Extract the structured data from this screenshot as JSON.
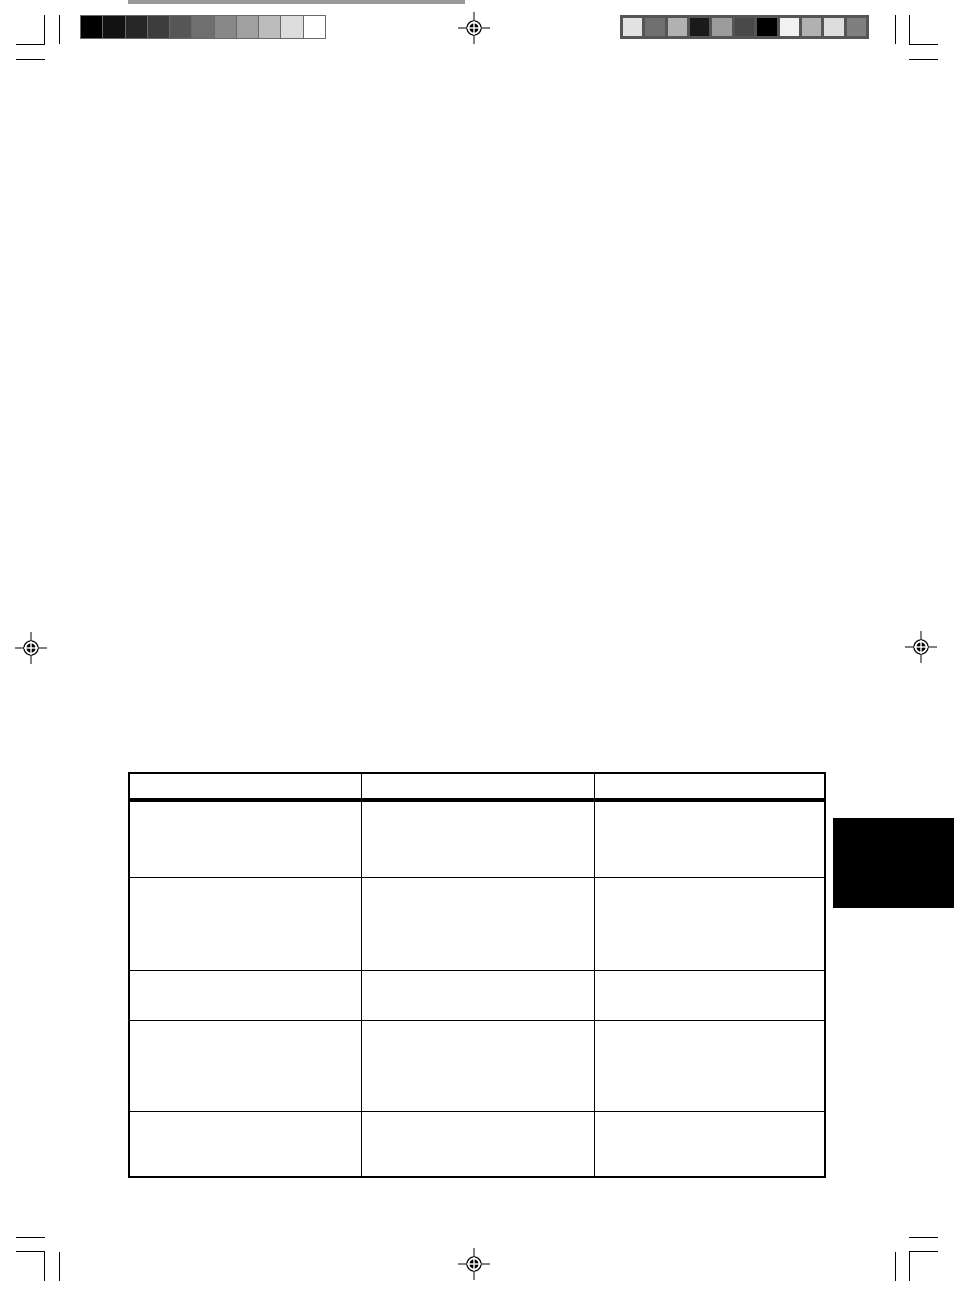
{
  "page": {
    "kind": "prepress-manual-page",
    "background_color": "#ffffff",
    "mark_color": "#000000"
  },
  "calibration": {
    "grayscale_bar": {
      "name": "grayscale-step-wedge",
      "frame_color": "#6a6a6a",
      "swatches": [
        "#000000",
        "#121212",
        "#262626",
        "#3d3d3d",
        "#565656",
        "#6f6f6f",
        "#888888",
        "#a0a0a0",
        "#bcbcbc",
        "#dcdcdc",
        "#ffffff"
      ]
    },
    "color_bar": {
      "name": "color-control-strip",
      "frame_color": "#555555",
      "swatches": [
        "#e2e2e2",
        "#6f6f6f",
        "#b1b1b1",
        "#1a1a1a",
        "#9c9c9c",
        "#484848",
        "#000000",
        "#f1f1f1",
        "#b1b1b1",
        "#dddddd",
        "#7f7f7f"
      ]
    }
  },
  "rules": {
    "color": "#999999",
    "count": 4
  },
  "table": {
    "columns": [
      "",
      "",
      ""
    ],
    "rows": [
      [
        "",
        "",
        ""
      ],
      [
        "",
        "",
        ""
      ],
      [
        "",
        "",
        ""
      ],
      [
        "",
        "",
        ""
      ],
      [
        "",
        "",
        ""
      ]
    ]
  },
  "side_tab": {
    "color": "#000000"
  }
}
